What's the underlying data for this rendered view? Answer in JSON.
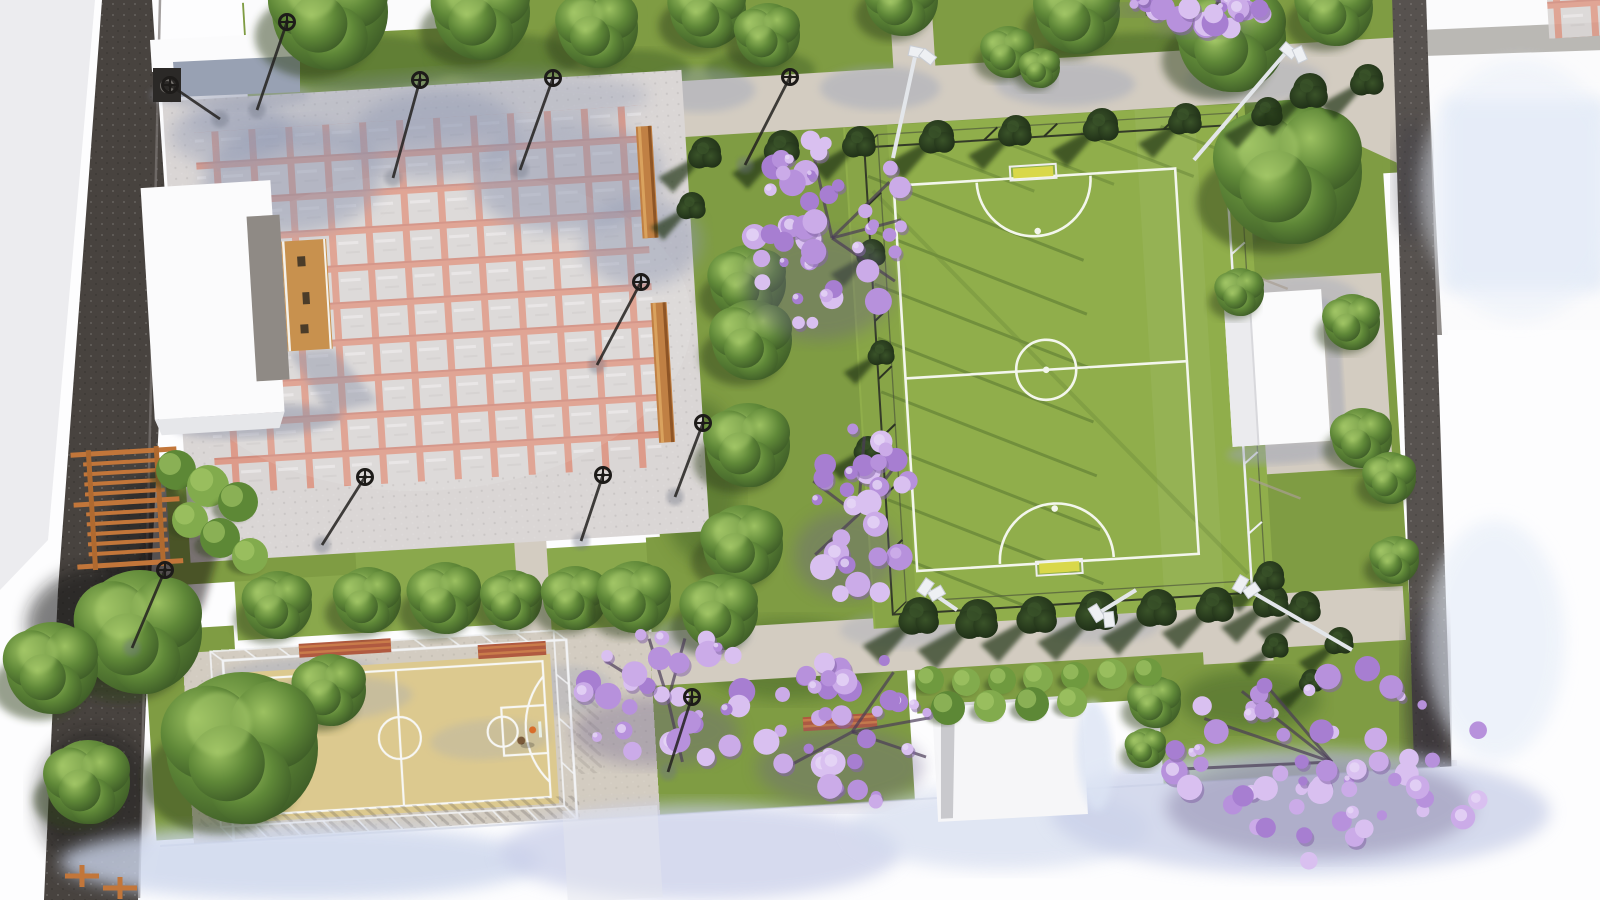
{
  "scene": {
    "kind": "aerial-3d-render",
    "subject": "public park landscape plan with plaza, soccer field, basketball court, pergola and trees",
    "colors": {
      "bg": "#fdfdfe",
      "wedge": "#ececef",
      "lawn": "#7f9c43",
      "lawnLight": "#8aa84c",
      "shadowLawn": "#30421d",
      "turf": "#90ae4b",
      "turfLine": "#f3f6ec",
      "path": "#d3ccc1",
      "pathShadow": "#98a1b8",
      "plaza": "#dad6d5",
      "plazaLine": "#dd9b8a",
      "road": "#48433f",
      "roadRight": "#57524f",
      "curb": "#7d7876",
      "court": "#dcc98f",
      "courtLine": "#f7f7f4",
      "cage": "#f2f3f5",
      "wood": "#c8914e",
      "benchWood": "#c08044",
      "benchRed": "#b05a40",
      "pergola": "#c2763a",
      "treeLight": "#a6c96b",
      "treeMid": "#5f8838",
      "treeDark": "#3c5a26",
      "conifer": "#223419",
      "coniferHi": "#3a5329",
      "jac1": "#cbabe8",
      "jac2": "#b791dc",
      "jac3": "#a77ed1",
      "jac4": "#d9c0f0",
      "jacBranch": "#4b3c58",
      "jacShadow": "#6a5e8a",
      "white": "#fbfbfc",
      "wall": "#98a1b3",
      "blueShadow": "#ccd6ec",
      "goal": "#d9d84a",
      "lamp": "#1d1b19",
      "flood": "#e3e6ea",
      "gray": "#9ba1b4"
    },
    "trees": [
      [
        330,
        12,
        58
      ],
      [
        482,
        12,
        48
      ],
      [
        598,
        28,
        40
      ],
      [
        708,
        10,
        38
      ],
      [
        768,
        35,
        32
      ],
      [
        902,
        0,
        36
      ],
      [
        1078,
        12,
        42
      ],
      [
        1008,
        52,
        26
      ],
      [
        1040,
        68,
        20
      ],
      [
        1232,
        38,
        54
      ],
      [
        1335,
        8,
        38
      ],
      [
        1290,
        172,
        72
      ],
      [
        1240,
        292,
        24
      ],
      [
        748,
        283,
        38
      ],
      [
        752,
        340,
        40
      ],
      [
        1352,
        322,
        28
      ],
      [
        748,
        445,
        42
      ],
      [
        1362,
        438,
        30
      ],
      [
        1390,
        478,
        26
      ],
      [
        743,
        545,
        40
      ],
      [
        1395,
        560,
        24
      ],
      [
        278,
        605,
        34
      ],
      [
        368,
        600,
        33
      ],
      [
        445,
        598,
        36
      ],
      [
        512,
        600,
        30
      ],
      [
        575,
        598,
        32
      ],
      [
        635,
        597,
        36
      ],
      [
        720,
        612,
        38
      ],
      [
        140,
        632,
        62
      ],
      [
        52,
        668,
        46
      ],
      [
        330,
        690,
        36
      ],
      [
        1155,
        702,
        26
      ],
      [
        1146,
        748,
        20
      ],
      [
        242,
        748,
        76
      ],
      [
        88,
        782,
        42
      ]
    ],
    "conifers": [
      [
        706,
        152,
        15
      ],
      [
        783,
        146,
        16
      ],
      [
        860,
        141,
        15
      ],
      [
        938,
        136,
        16
      ],
      [
        1016,
        130,
        15
      ],
      [
        1102,
        124,
        16
      ],
      [
        1186,
        118,
        15
      ],
      [
        1268,
        111,
        14
      ],
      [
        1310,
        90,
        17
      ],
      [
        1368,
        79,
        15
      ],
      [
        692,
        205,
        13
      ],
      [
        872,
        252,
        13
      ],
      [
        882,
        352,
        12
      ],
      [
        868,
        448,
        12
      ],
      [
        920,
        615,
        18
      ],
      [
        978,
        618,
        19
      ],
      [
        1038,
        614,
        18
      ],
      [
        1098,
        610,
        19
      ],
      [
        1158,
        607,
        18
      ],
      [
        1216,
        604,
        17
      ],
      [
        1272,
        600,
        16
      ],
      [
        1270,
        575,
        14
      ],
      [
        1305,
        606,
        15
      ],
      [
        1340,
        640,
        13
      ],
      [
        1276,
        645,
        12
      ],
      [
        1312,
        680,
        11
      ]
    ],
    "jacarandas": [
      {
        "x": 832,
        "y": 238,
        "rx": 78,
        "ry": 108,
        "n": 46
      },
      {
        "x": 858,
        "y": 515,
        "rx": 55,
        "ry": 88,
        "n": 30
      },
      {
        "x": 668,
        "y": 700,
        "rx": 88,
        "ry": 70,
        "n": 32
      },
      {
        "x": 852,
        "y": 732,
        "rx": 88,
        "ry": 78,
        "n": 34
      },
      {
        "x": 1332,
        "y": 762,
        "rx": 162,
        "ry": 100,
        "n": 60
      },
      {
        "x": 1213,
        "y": 14,
        "rx": 50,
        "ry": 24,
        "n": 16
      },
      {
        "x": 1146,
        "y": 4,
        "rx": 22,
        "ry": 13,
        "n": 7
      }
    ],
    "hedges": [
      [
        930,
        680,
        14,
        0
      ],
      [
        966,
        682,
        14,
        1
      ],
      [
        1002,
        680,
        14,
        0
      ],
      [
        1038,
        678,
        15,
        1
      ],
      [
        1075,
        676,
        14,
        0
      ],
      [
        1112,
        674,
        15,
        1
      ],
      [
        1148,
        672,
        14,
        0
      ],
      [
        948,
        708,
        17,
        2
      ],
      [
        990,
        706,
        16,
        1
      ],
      [
        1032,
        704,
        17,
        2
      ],
      [
        1072,
        702,
        15,
        1
      ],
      [
        176,
        470,
        20,
        2
      ],
      [
        208,
        486,
        21,
        1
      ],
      [
        238,
        502,
        20,
        2
      ],
      [
        190,
        520,
        18,
        1
      ],
      [
        220,
        538,
        20,
        2
      ],
      [
        250,
        556,
        18,
        1
      ]
    ],
    "lamps": [
      {
        "x": 287,
        "y": 22,
        "dx": -30,
        "dy": 88
      },
      {
        "x": 420,
        "y": 80,
        "dx": -27,
        "dy": 98
      },
      {
        "x": 553,
        "y": 78,
        "dx": -33,
        "dy": 92
      },
      {
        "x": 790,
        "y": 77,
        "dx": -45,
        "dy": 88
      },
      {
        "x": 641,
        "y": 282,
        "dx": -44,
        "dy": 83
      },
      {
        "x": 365,
        "y": 477,
        "dx": -43,
        "dy": 68
      },
      {
        "x": 603,
        "y": 475,
        "dx": -22,
        "dy": 66
      },
      {
        "x": 703,
        "y": 423,
        "dx": -28,
        "dy": 74
      },
      {
        "x": 165,
        "y": 570,
        "dx": -33,
        "dy": 78
      },
      {
        "x": 692,
        "y": 697,
        "dx": -24,
        "dy": 75
      },
      {
        "x": 170,
        "y": 85,
        "dx": 50,
        "dy": 34
      }
    ],
    "floodlights": [
      {
        "hx": 916,
        "hy": 52,
        "px": 893,
        "py": 158
      },
      {
        "hx": 1288,
        "hy": 50,
        "px": 1194,
        "py": 160
      },
      {
        "hx": 925,
        "hy": 588,
        "px": 957,
        "py": 610
      },
      {
        "hx": 1240,
        "hy": 585,
        "px": 1352,
        "py": 650
      },
      {
        "hx": 1097,
        "hy": 614,
        "px": 1136,
        "py": 590
      }
    ],
    "benchesH": [
      [
        345,
        648,
        92
      ],
      [
        512,
        650,
        68
      ],
      [
        840,
        722,
        74
      ]
    ],
    "benchesV": [
      [
        654,
        195,
        112
      ],
      [
        658,
        386,
        140
      ]
    ],
    "picnicTables": [
      [
        82,
        876
      ],
      [
        120,
        888
      ]
    ],
    "figures": [
      [
        268,
        744
      ],
      [
        521,
        748
      ]
    ]
  }
}
